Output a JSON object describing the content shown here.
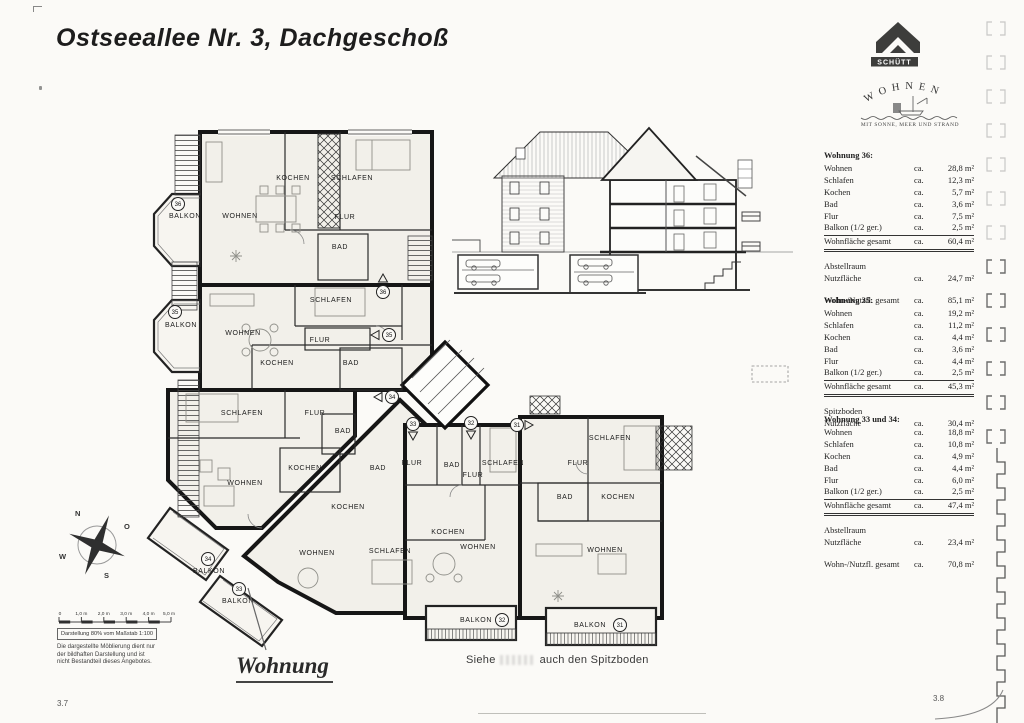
{
  "page": {
    "title": "Ostseeallee Nr. 3, Dachgeschoß",
    "number_left": "3.7",
    "number_right": "3.8"
  },
  "logo": {
    "brand": "SCHÜTT",
    "arc_text": "WOHNEN",
    "tagline": "MIT SONNE, MEER UND STRAND"
  },
  "tables": [
    {
      "title": "Wohnung 36:",
      "rows": [
        {
          "label": "Wohnen",
          "ca": "ca.",
          "value": "28,8 m²"
        },
        {
          "label": "Schlafen",
          "ca": "ca.",
          "value": "12,3 m²"
        },
        {
          "label": "Kochen",
          "ca": "ca.",
          "value": "5,7 m²"
        },
        {
          "label": "Bad",
          "ca": "ca.",
          "value": "3,6 m²"
        },
        {
          "label": "Flur",
          "ca": "ca.",
          "value": "7,5 m²"
        },
        {
          "label": "Balkon (1/2 ger.)",
          "ca": "ca.",
          "value": "2,5 m²"
        }
      ],
      "total": {
        "label": "Wohnfläche gesamt",
        "ca": "ca.",
        "value": "60,4 m²"
      },
      "extra_title": "Abstellraum",
      "extra": {
        "label": "Nutzfläche",
        "ca": "ca.",
        "value": "24,7 m²"
      },
      "grand": {
        "label": "Wohn-/Nutzfl. gesamt",
        "ca": "ca.",
        "value": "85,1 m²"
      }
    },
    {
      "title": "Wohnung 35:",
      "rows": [
        {
          "label": "Wohnen",
          "ca": "ca.",
          "value": "19,2 m²"
        },
        {
          "label": "Schlafen",
          "ca": "ca.",
          "value": "11,2 m²"
        },
        {
          "label": "Kochen",
          "ca": "ca.",
          "value": "4,4 m²"
        },
        {
          "label": "Bad",
          "ca": "ca.",
          "value": "3,6 m²"
        },
        {
          "label": "Flur",
          "ca": "ca.",
          "value": "4,4 m²"
        },
        {
          "label": "Balkon (1/2 ger.)",
          "ca": "ca.",
          "value": "2,5 m²"
        }
      ],
      "total": {
        "label": "Wohnfläche gesamt",
        "ca": "ca.",
        "value": "45,3 m²"
      },
      "extra_title": "Spitzboden",
      "extra": {
        "label": "Nutzfläche",
        "ca": "ca.",
        "value": "30,4 m²"
      }
    },
    {
      "title": "Wohnung 33 und 34:",
      "rows": [
        {
          "label": "Wohnen",
          "ca": "ca.",
          "value": "18,8 m²"
        },
        {
          "label": "Schlafen",
          "ca": "ca.",
          "value": "10,8 m²"
        },
        {
          "label": "Kochen",
          "ca": "ca.",
          "value": "4,9 m²"
        },
        {
          "label": "Bad",
          "ca": "ca.",
          "value": "4,4 m²"
        },
        {
          "label": "Flur",
          "ca": "ca.",
          "value": "6,0 m²"
        },
        {
          "label": "Balkon (1/2 ger.)",
          "ca": "ca.",
          "value": "2,5 m²"
        }
      ],
      "total": {
        "label": "Wohnfläche gesamt",
        "ca": "ca.",
        "value": "47,4 m²"
      },
      "extra_title": "Abstellraum",
      "extra": {
        "label": "Nutzfläche",
        "ca": "ca.",
        "value": "23,4 m²"
      },
      "grand": {
        "label": "Wohn-/Nutzfl. gesamt",
        "ca": "ca.",
        "value": "70,8 m²"
      }
    }
  ],
  "plan": {
    "apt36": {
      "no": "36",
      "balkon": "BALKON",
      "wohnen": "WOHNEN",
      "kochen": "KOCHEN",
      "schlafen": "SCHLAFEN",
      "flur": "FLUR",
      "bad": "BAD"
    },
    "apt35": {
      "no": "35",
      "balkon": "BALKON",
      "wohnen": "WOHNEN",
      "kochen": "KOCHEN",
      "schlafen": "SCHLAFEN",
      "flur": "FLUR",
      "bad": "BAD"
    },
    "apt34": {
      "no": "34",
      "balkon": "BALKON",
      "wohnen": "WOHNEN",
      "kochen": "KOCHEN",
      "schlafen": "SCHLAFEN",
      "flur": "FLUR",
      "bad": "BAD"
    },
    "apt33": {
      "no": "33",
      "balkon": "BALKON",
      "wohnen": "WOHNEN",
      "kochen": "KOCHEN",
      "schlafen": "SCHLAFEN",
      "flur": "FLUR",
      "bad": "BAD"
    },
    "apt32": {
      "no": "32",
      "balkon": "BALKON",
      "wohnen": "WOHNEN",
      "kochen": "KOCHEN",
      "schlafen": "SCHLAFEN",
      "flur": "FLUR",
      "bad": "BAD"
    },
    "apt31": {
      "no": "31",
      "balkon": "BALKON",
      "wohnen": "WOHNEN",
      "kochen": "KOCHEN",
      "schlafen": "SCHLAFEN",
      "flur": "FLUR",
      "bad": "BAD"
    },
    "compass": {
      "n": "N",
      "o": "O",
      "s": "S",
      "w": "W"
    },
    "scale": {
      "t0": "0",
      "t1": "1,0 m",
      "t2": "2,0 m",
      "t3": "3,0 m",
      "t4": "4,0 m",
      "t5": "5,0 m",
      "note": "Darstellung 80% vom Maßstab 1:100"
    },
    "disclaimer": {
      "l1": "Die dargestellte Möblierung dient nur",
      "l2": "der bildhaften Darstellung und ist",
      "l3": "nicht Bestandteil dieses Angebotes."
    },
    "annotation": "Wohnung",
    "note": {
      "part1": "Siehe",
      "part2": "auch den Spitzboden"
    }
  }
}
